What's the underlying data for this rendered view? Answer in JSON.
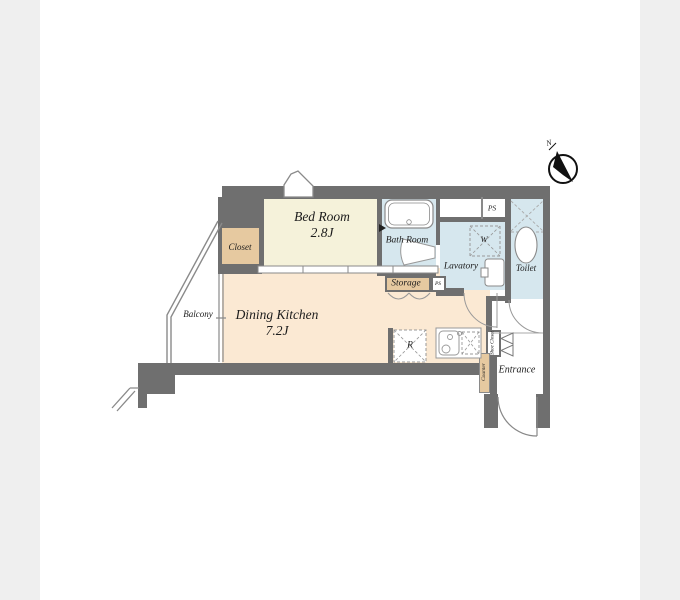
{
  "plan": {
    "rooms": {
      "bed_room": {
        "name": "Bed Room",
        "size": "2.8J"
      },
      "dining_kitchen": {
        "name": "Dining Kitchen",
        "size": "7.2J"
      },
      "closet": {
        "name": "Closet"
      },
      "bath_room": {
        "name": "Bath Room"
      },
      "lavatory": {
        "name": "Lavatory"
      },
      "toilet": {
        "name": "Toilet"
      },
      "storage": {
        "name": "Storage"
      },
      "balcony": {
        "name": "Balcony"
      },
      "entrance": {
        "name": "Entrance"
      },
      "shoe_closet": {
        "name": "Shoe Closet"
      },
      "counter": {
        "name": "Counter"
      },
      "ps_upper": {
        "name": "PS"
      },
      "ps_lower": {
        "name": "PS"
      }
    },
    "fixtures": {
      "washing_machine": {
        "label": "W"
      },
      "refrigerator": {
        "label": "R"
      }
    },
    "compass": {
      "label": "N"
    },
    "colors": {
      "wall": "#6f6f6f",
      "bedroom_floor": "#f5f2da",
      "dining_kitchen_floor": "#fbe9d3",
      "closet_fill": "#e6c9a0",
      "wet_area_fill": "#d6e7ee",
      "page_background": "#efefef",
      "sheet_background": "#ffffff"
    }
  }
}
